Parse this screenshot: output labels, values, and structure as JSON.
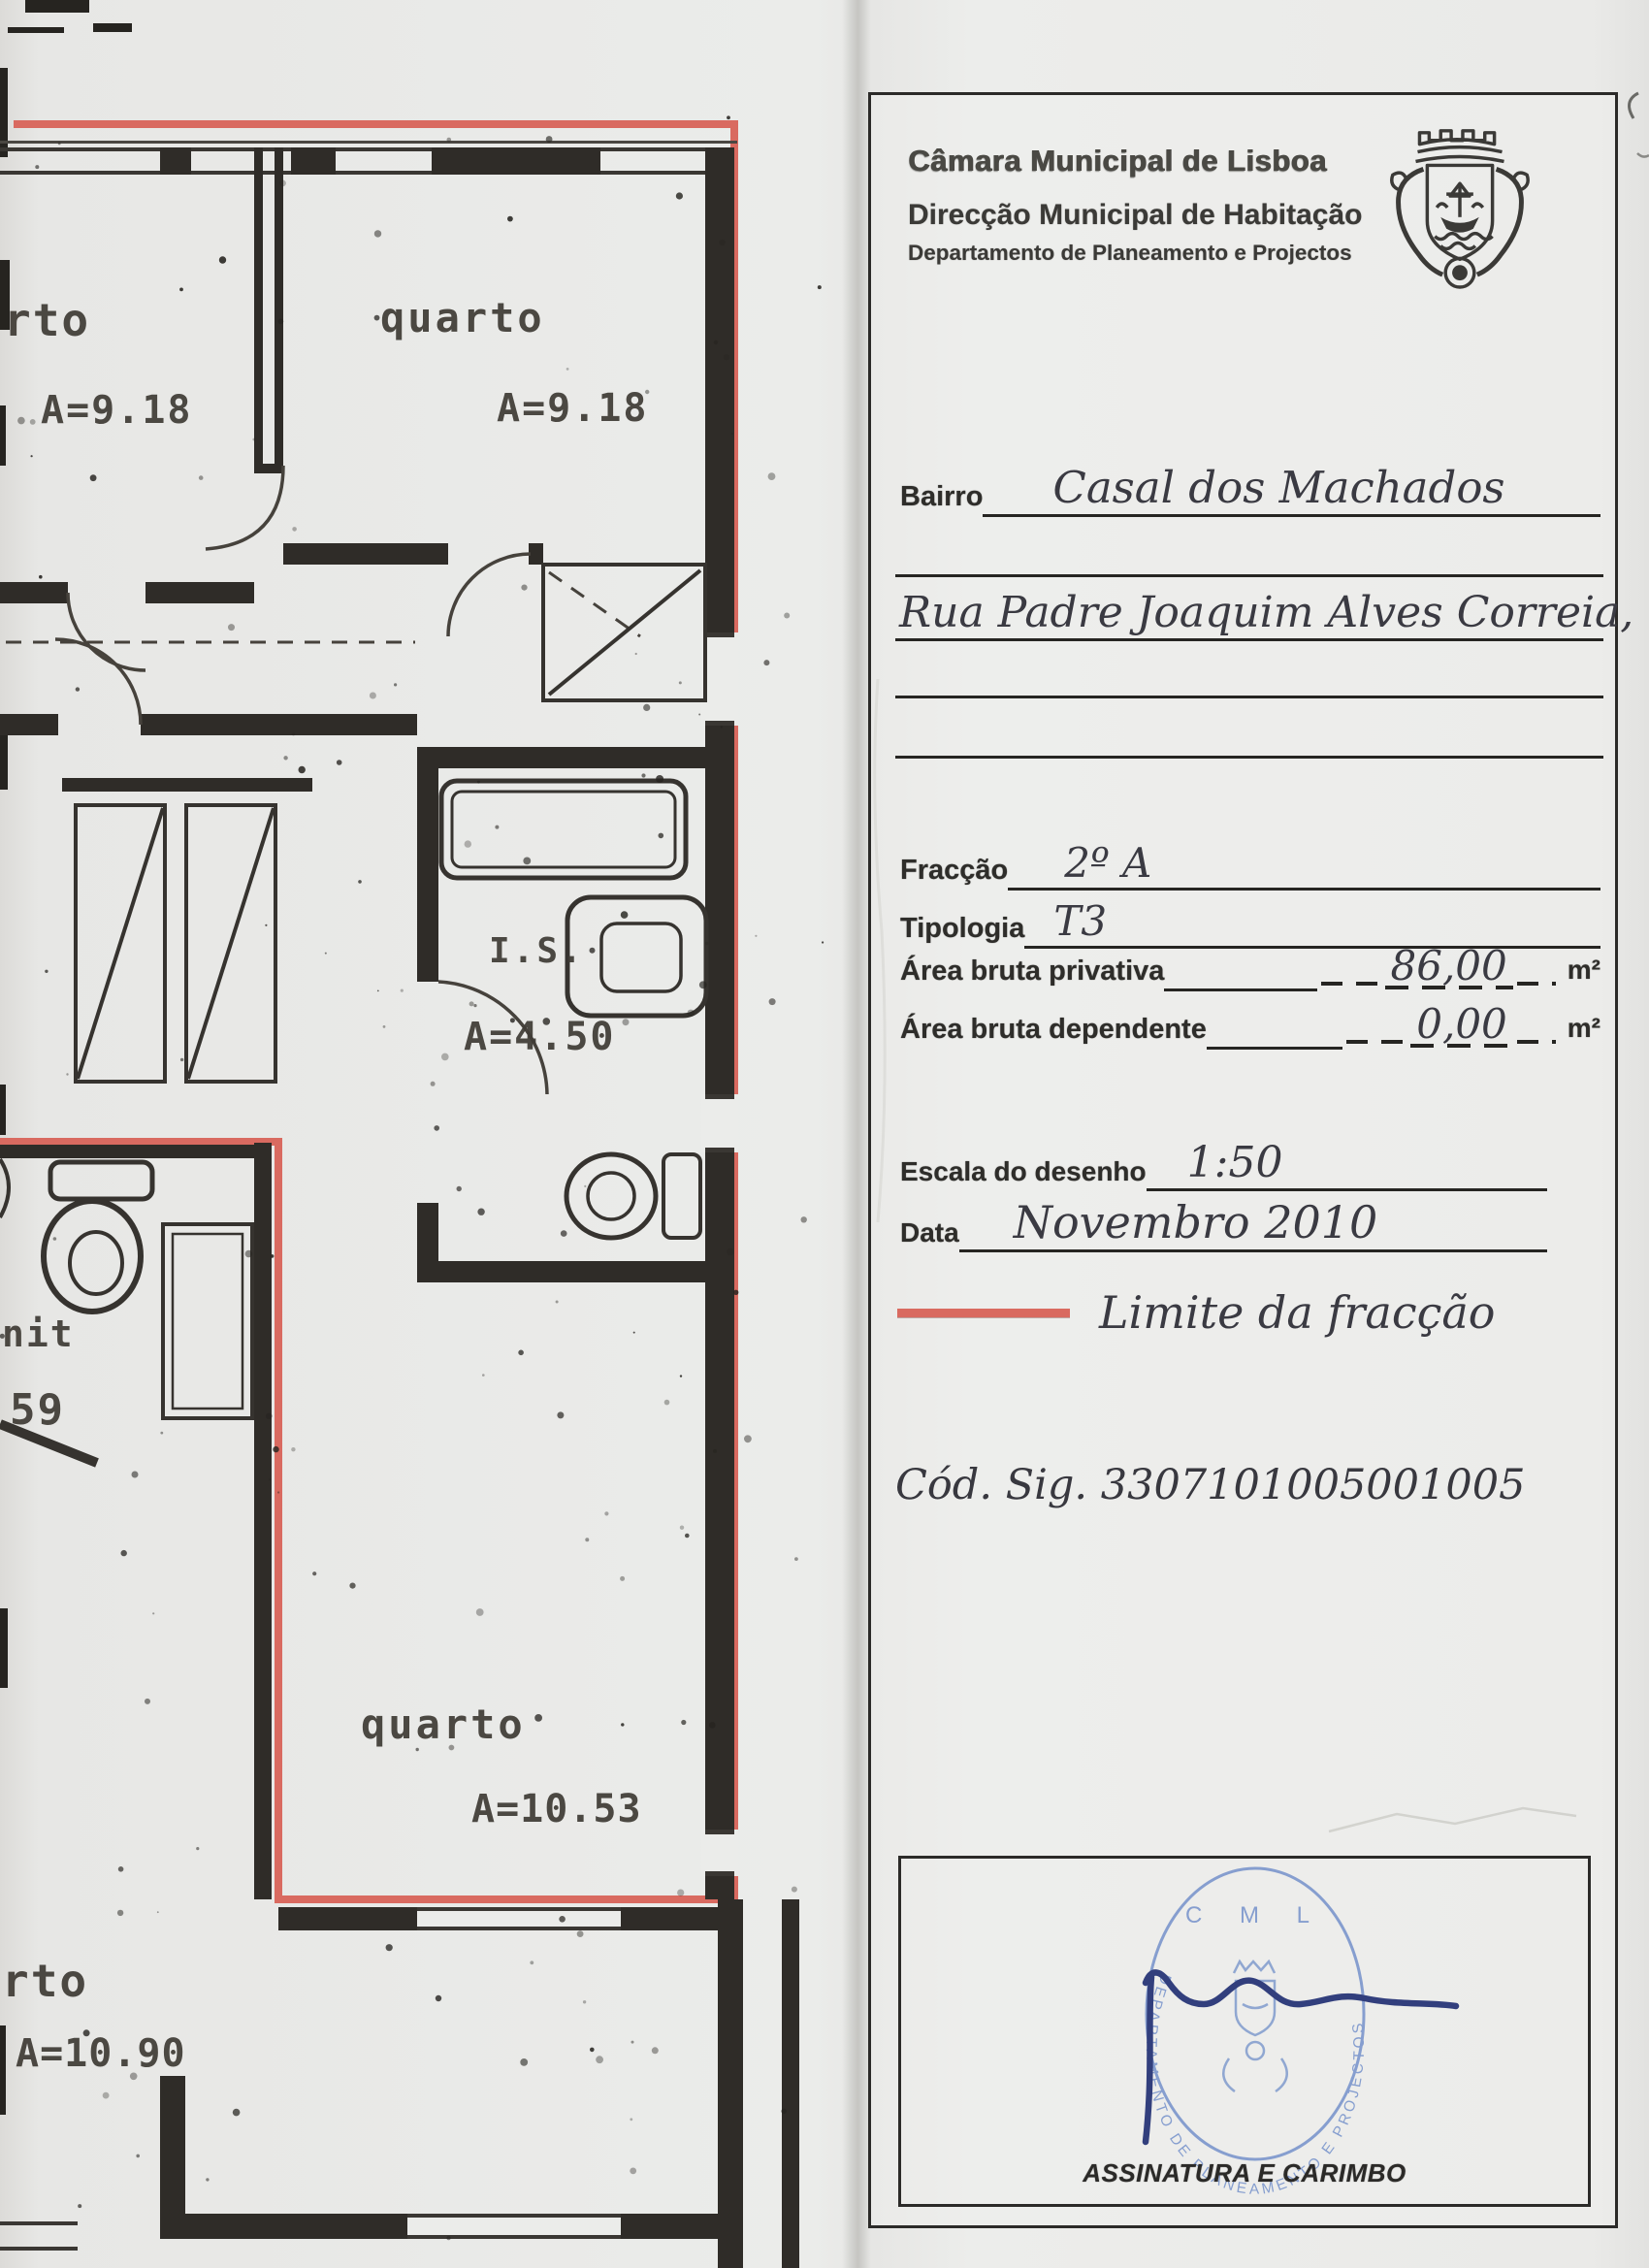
{
  "header": {
    "org_line1": "Câmara Municipal de Lisboa",
    "org_line2": "Direcção Municipal de Habitação",
    "org_line3": "Departamento de Planeamento e Projectos"
  },
  "form": {
    "bairro_label": "Bairro",
    "bairro_value": "Casal dos Machados",
    "address_value": "Rua Padre Joaquim Alves Correia, nº 6",
    "fraccao_label": "Fracção",
    "fraccao_value": "2º A",
    "tipologia_label": "Tipologia",
    "tipologia_value": "T3",
    "area_privativa_label": "Área bruta privativa",
    "area_privativa_value": "86,00",
    "area_privativa_unit": "m²",
    "area_dependente_label": "Área bruta dependente",
    "area_dependente_value": "0,00",
    "area_dependente_unit": "m²",
    "escala_label": "Escala do desenho",
    "escala_value": "1:50",
    "data_label": "Data",
    "data_value": "Novembro 2010",
    "legend_label": "Limite da fracção",
    "legend_color": "#d96a60",
    "cod_sig": "Cód. Sig. 3307101005001005"
  },
  "stamp": {
    "org_abbrev": "C M L",
    "ring_text": "DEPARTAMENTO DE PLANEAMENTO E PROJECTOS",
    "caption": "ASSINATURA E CARIMBO",
    "ink_color": "#7b96cc"
  },
  "floorplan": {
    "limit_color": "#d96a60",
    "rooms": [
      {
        "name": "quarto-top-left",
        "label": "rto",
        "area": "A=9.18"
      },
      {
        "name": "quarto-top-right",
        "label": "quarto",
        "area": "A=9.18"
      },
      {
        "name": "is-bathroom",
        "label": "I.S.",
        "area": "A=4.50"
      },
      {
        "name": "wc-left",
        "label": "nit",
        "area": "59"
      },
      {
        "name": "quarto-bottom",
        "label": "quarto",
        "area": "A=10.53"
      },
      {
        "name": "quarto-bottom-left",
        "label": "rto",
        "area": "A=10.90"
      }
    ]
  }
}
